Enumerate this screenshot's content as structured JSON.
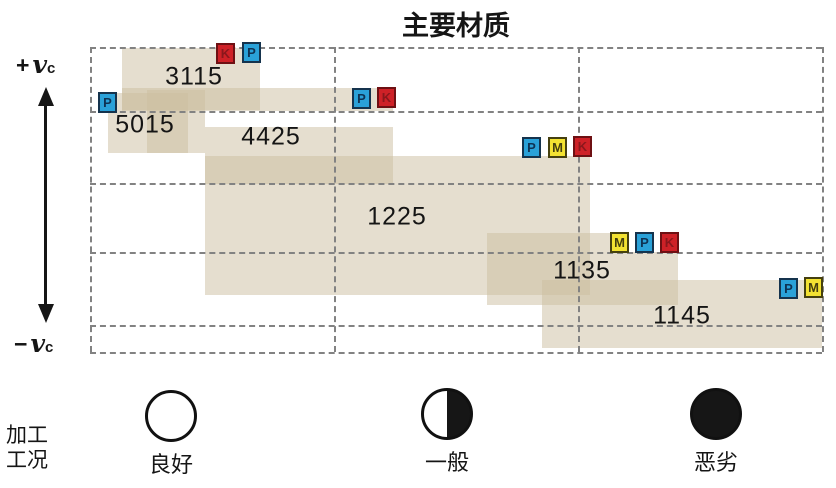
{
  "title": "主要材质",
  "axis": {
    "plus_sign": "+",
    "minus_sign": "−",
    "symbol": "v",
    "subscript": "c"
  },
  "condition_legend": {
    "caption": [
      "加工",
      "工况"
    ],
    "items": [
      {
        "label": "良好",
        "fill": "empty",
        "cx": 171,
        "cy": 416
      },
      {
        "label": "一般",
        "fill": "half",
        "cx": 447,
        "cy": 414
      },
      {
        "label": "恶劣",
        "fill": "full",
        "cx": 716,
        "cy": 414
      }
    ]
  },
  "chart_data": {
    "type": "range-chart",
    "title": "主要材质",
    "x_categories": [
      "良好",
      "一般",
      "恶劣"
    ],
    "y_top_label": "+vc",
    "y_bottom_label": "−vc",
    "area": [
      90,
      47,
      732,
      305
    ],
    "grid_h": [
      47,
      111,
      183,
      252,
      325,
      352
    ],
    "grid_v": [
      90,
      334,
      578,
      822
    ],
    "block_color": "rgba(203,190,160,0.5)",
    "badge_colors": {
      "P": {
        "bg": "#2aa1d8",
        "border": "#15334d",
        "text": "#0e3253"
      },
      "M": {
        "bg": "#f3e232",
        "border": "#45400f",
        "text": "#45400f"
      },
      "K": {
        "bg": "#ce2127",
        "border": "#6e1013",
        "text": "#8a171c"
      }
    },
    "grades": [
      {
        "name": "3115",
        "iso_classes": [
          "K",
          "P"
        ],
        "rects": [
          [
            122,
            48,
            138,
            62
          ]
        ],
        "label_xy": [
          194,
          77
        ],
        "badges": [
          {
            "k": "K",
            "x": 216,
            "y": 43
          },
          {
            "k": "P",
            "x": 242,
            "y": 42
          }
        ]
      },
      {
        "name": "5015",
        "iso_classes": [
          "P"
        ],
        "rects": [
          [
            108,
            93,
            80,
            60
          ]
        ],
        "label_xy": [
          145,
          125
        ],
        "badges": [
          {
            "k": "P",
            "x": 98,
            "y": 92
          }
        ]
      },
      {
        "name": "4425",
        "iso_classes": [
          "P",
          "K"
        ],
        "rects": [
          [
            122,
            88,
            271,
            23
          ],
          [
            147,
            90,
            58,
            63
          ],
          [
            205,
            127,
            188,
            57
          ]
        ],
        "label_xy": [
          271,
          137
        ],
        "badges": [
          {
            "k": "P",
            "x": 352,
            "y": 88
          },
          {
            "k": "K",
            "x": 377,
            "y": 87
          }
        ]
      },
      {
        "name": "1225",
        "iso_classes": [
          "P",
          "M",
          "K"
        ],
        "rects": [
          [
            205,
            156,
            385,
            139
          ]
        ],
        "label_xy": [
          397,
          217
        ],
        "badges": [
          {
            "k": "P",
            "x": 522,
            "y": 137
          },
          {
            "k": "M",
            "x": 548,
            "y": 137
          },
          {
            "k": "K",
            "x": 573,
            "y": 136
          }
        ]
      },
      {
        "name": "1135",
        "iso_classes": [
          "M",
          "P",
          "K"
        ],
        "rects": [
          [
            487,
            233,
            123,
            72
          ],
          [
            610,
            252,
            68,
            53
          ]
        ],
        "label_xy": [
          582,
          271
        ],
        "badges": [
          {
            "k": "M",
            "x": 610,
            "y": 232
          },
          {
            "k": "P",
            "x": 635,
            "y": 232
          },
          {
            "k": "K",
            "x": 660,
            "y": 232
          }
        ]
      },
      {
        "name": "1145",
        "iso_classes": [
          "P",
          "M"
        ],
        "rects": [
          [
            542,
            280,
            280,
            68
          ]
        ],
        "label_xy": [
          682,
          316
        ],
        "badges": [
          {
            "k": "P",
            "x": 779,
            "y": 278
          },
          {
            "k": "M",
            "x": 804,
            "y": 277
          }
        ]
      }
    ]
  }
}
